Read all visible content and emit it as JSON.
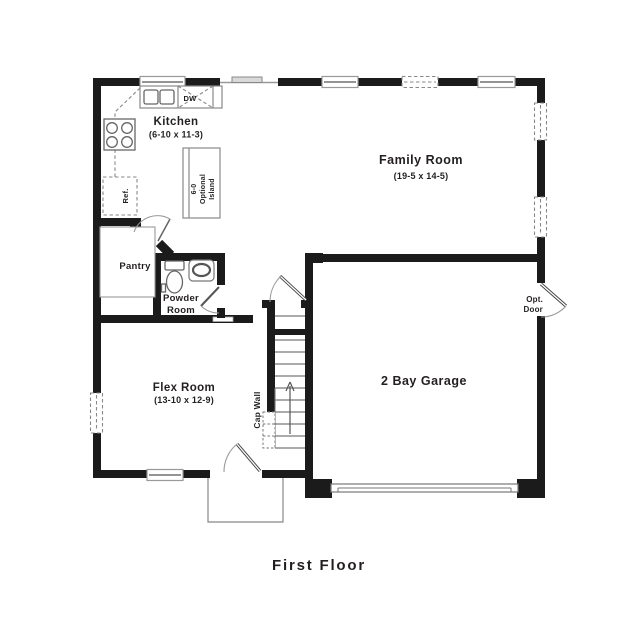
{
  "title": "First Floor",
  "rooms": {
    "kitchen": {
      "name": "Kitchen",
      "dims": "(6-10 x 11-3)"
    },
    "family_room": {
      "name": "Family Room",
      "dims": "(19-5 x 14-5)"
    },
    "flex_room": {
      "name": "Flex Room",
      "dims": "(13-10 x 12-9)"
    },
    "garage": {
      "name": "2 Bay Garage"
    },
    "pantry": {
      "name": "Pantry"
    },
    "powder_room": {
      "name_line1": "Powder",
      "name_line2": "Room"
    }
  },
  "fixtures": {
    "dishwasher": "DW",
    "refrigerator": "Ref.",
    "island_line1": "6-0",
    "island_line2": "Optional",
    "island_line3": "Island",
    "cap_wall": "Cap Wall",
    "opt_door_line1": "Opt.",
    "opt_door_line2": "Door"
  },
  "colors": {
    "wall": "#1b1b1b",
    "fixture_line": "#888888",
    "text": "#231f20",
    "background": "#ffffff"
  }
}
